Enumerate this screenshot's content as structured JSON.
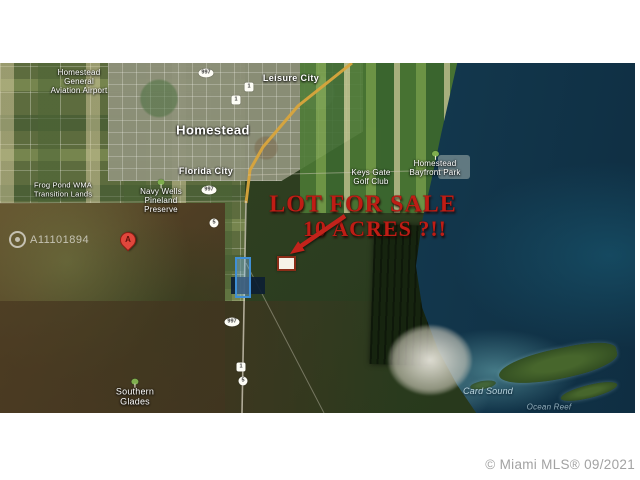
{
  "overlay": {
    "sale_line1": "LOT FOR SALE",
    "sale_line2": "10 ACRES ?!!",
    "watermark_id": "A11101894",
    "attribution": "© Miami MLS® 09/2021",
    "pin_letter": "A"
  },
  "colors": {
    "sale_red": "#bf1d15",
    "ocean": "#15455c",
    "wetland": "#2f4023",
    "farmland": "#5d6c3e",
    "urban": "#8f927b",
    "highway": "#d9a53c",
    "lot_outline_blue": "#3f8fd6"
  },
  "map": {
    "place_labels": [
      {
        "name": "homestead-general-aviation-airport",
        "lines": [
          "Homestead",
          "General",
          "Aviation Airport"
        ],
        "x": 79,
        "y": 82,
        "size": 8,
        "kind": "place",
        "tree": false
      },
      {
        "name": "homestead",
        "lines": [
          "Homestead"
        ],
        "x": 213,
        "y": 131,
        "size": 13,
        "kind": "city",
        "tree": false
      },
      {
        "name": "leisure-city",
        "lines": [
          "Leisure City"
        ],
        "x": 291,
        "y": 78,
        "size": 9,
        "kind": "city",
        "tree": false
      },
      {
        "name": "florida-city",
        "lines": [
          "Florida City"
        ],
        "x": 206,
        "y": 171,
        "size": 9,
        "kind": "city",
        "tree": false
      },
      {
        "name": "keys-gate-golf-club",
        "lines": [
          "Keys Gate",
          "Golf Club"
        ],
        "x": 371,
        "y": 177,
        "size": 8,
        "kind": "place",
        "tree": false
      },
      {
        "name": "navy-wells-pineland-preserve",
        "lines": [
          "Navy Wells",
          "Pineland",
          "Preserve"
        ],
        "x": 161,
        "y": 201,
        "size": 8,
        "kind": "place",
        "tree": true
      },
      {
        "name": "homestead-bayfront-park",
        "lines": [
          "Homestead",
          "Bayfront Park"
        ],
        "x": 435,
        "y": 168,
        "size": 8,
        "kind": "place",
        "tree": true
      },
      {
        "name": "frog-pond-transition-lands",
        "lines": [
          "Frog Pond WMA",
          "Transition Lands"
        ],
        "x": 63,
        "y": 190,
        "size": 7.5,
        "kind": "place",
        "tree": false
      },
      {
        "name": "southern-glades",
        "lines": [
          "Southern",
          "Glades"
        ],
        "x": 135,
        "y": 397,
        "size": 9,
        "kind": "place",
        "tree": true
      },
      {
        "name": "card-sound",
        "lines": [
          "Card Sound"
        ],
        "x": 488,
        "y": 391,
        "size": 9,
        "kind": "water",
        "tree": false
      },
      {
        "name": "ocean-reef",
        "lines": [
          "Ocean Reef"
        ],
        "x": 549,
        "y": 407,
        "size": 8,
        "kind": "water faint",
        "tree": false
      }
    ],
    "road_shields": [
      {
        "text": "997",
        "shape": "oval",
        "x": 206,
        "y": 73
      },
      {
        "text": "1",
        "shape": "square",
        "x": 249,
        "y": 87
      },
      {
        "text": "1",
        "shape": "square",
        "x": 236,
        "y": 100
      },
      {
        "text": "997",
        "shape": "oval",
        "x": 209,
        "y": 190
      },
      {
        "text": "5",
        "shape": "circle",
        "x": 214,
        "y": 223
      },
      {
        "text": "997",
        "shape": "oval",
        "x": 232,
        "y": 322
      },
      {
        "text": "1",
        "shape": "square",
        "x": 241,
        "y": 367
      },
      {
        "text": "5",
        "shape": "circle",
        "x": 243,
        "y": 381
      }
    ]
  }
}
